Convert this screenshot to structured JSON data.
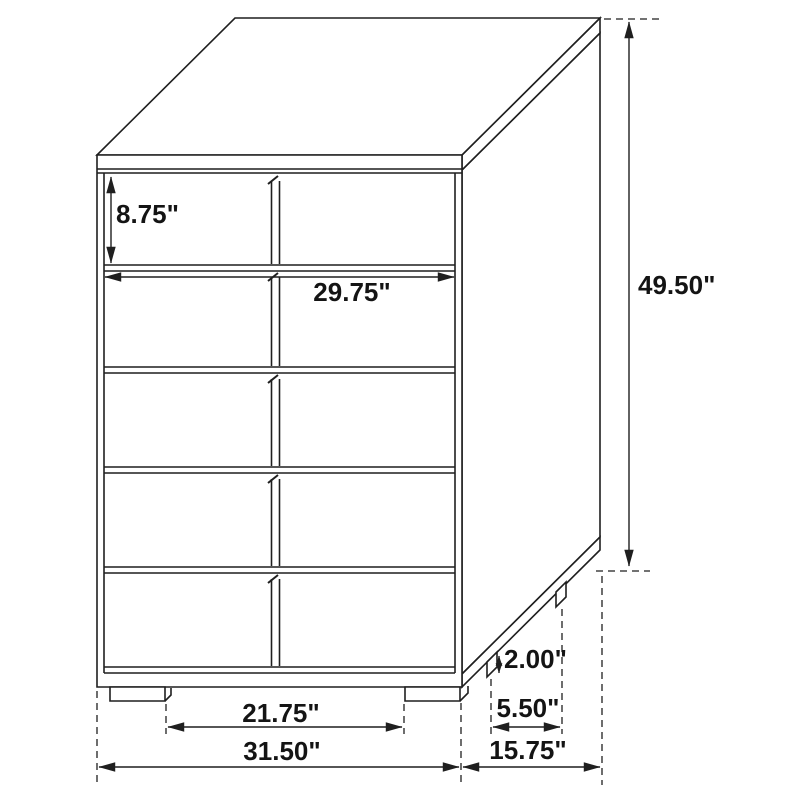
{
  "diagram": {
    "kind": "furniture-dimension-line-drawing",
    "subject": "five-drawer two-column chest, isometric view",
    "unit": "inches",
    "colors": {
      "line": "#1f1f1f",
      "text": "#141414",
      "background": "#ffffff"
    },
    "labels": {
      "top_drawer_height": "8.75\"",
      "drawer_width": "29.75\"",
      "overall_height": "49.50\"",
      "foot_height": "2.00\"",
      "foot_depth_spacing": "5.50\"",
      "foot_width_spacing": "21.75\"",
      "overall_width": "31.50\"",
      "overall_depth": "15.75\""
    },
    "values": {
      "top_drawer_height": 8.75,
      "drawer_width": 29.75,
      "overall_height": 49.5,
      "foot_height": 2.0,
      "foot_depth_spacing": 5.5,
      "foot_width_spacing": 21.75,
      "overall_width": 31.5,
      "overall_depth": 15.75
    }
  }
}
